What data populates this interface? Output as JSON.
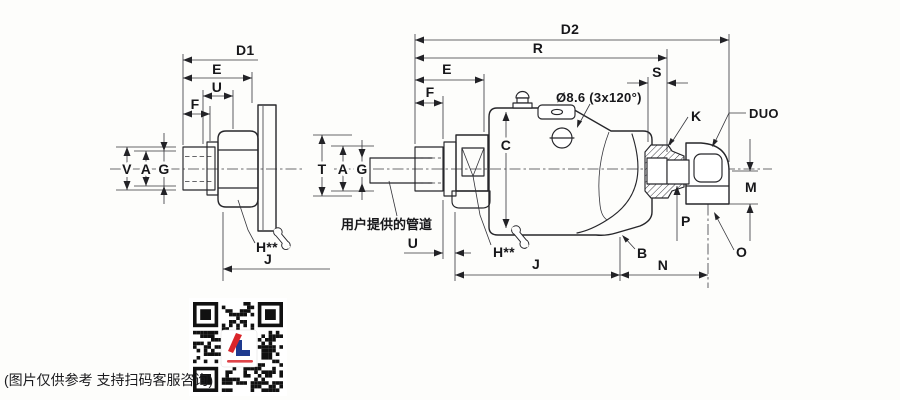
{
  "labels": {
    "left": {
      "d1": "D1",
      "e": "E",
      "u": "U",
      "f": "F",
      "v": "V",
      "a": "A",
      "g": "G",
      "h": "H**",
      "j": "J"
    },
    "middle": {
      "d2": "D2",
      "r": "R",
      "e": "E",
      "f": "F",
      "s": "S",
      "hole_note": "Ø8.6 (3x120°)",
      "c": "C",
      "t": "T",
      "a": "A",
      "g": "G",
      "u": "U",
      "h": "H**",
      "j": "J",
      "n": "N",
      "b": "B",
      "k": "K",
      "duo": "DUO",
      "m": "M",
      "p": "P",
      "o": "O",
      "pipe_note": "用户提供的管道"
    }
  },
  "footer": {
    "disclaimer": "(图片仅供参考 支持扫码客服咨询)"
  },
  "colors": {
    "logo_red": "#d9252a",
    "logo_blue": "#1e3a8f",
    "ink": "#26262a"
  }
}
